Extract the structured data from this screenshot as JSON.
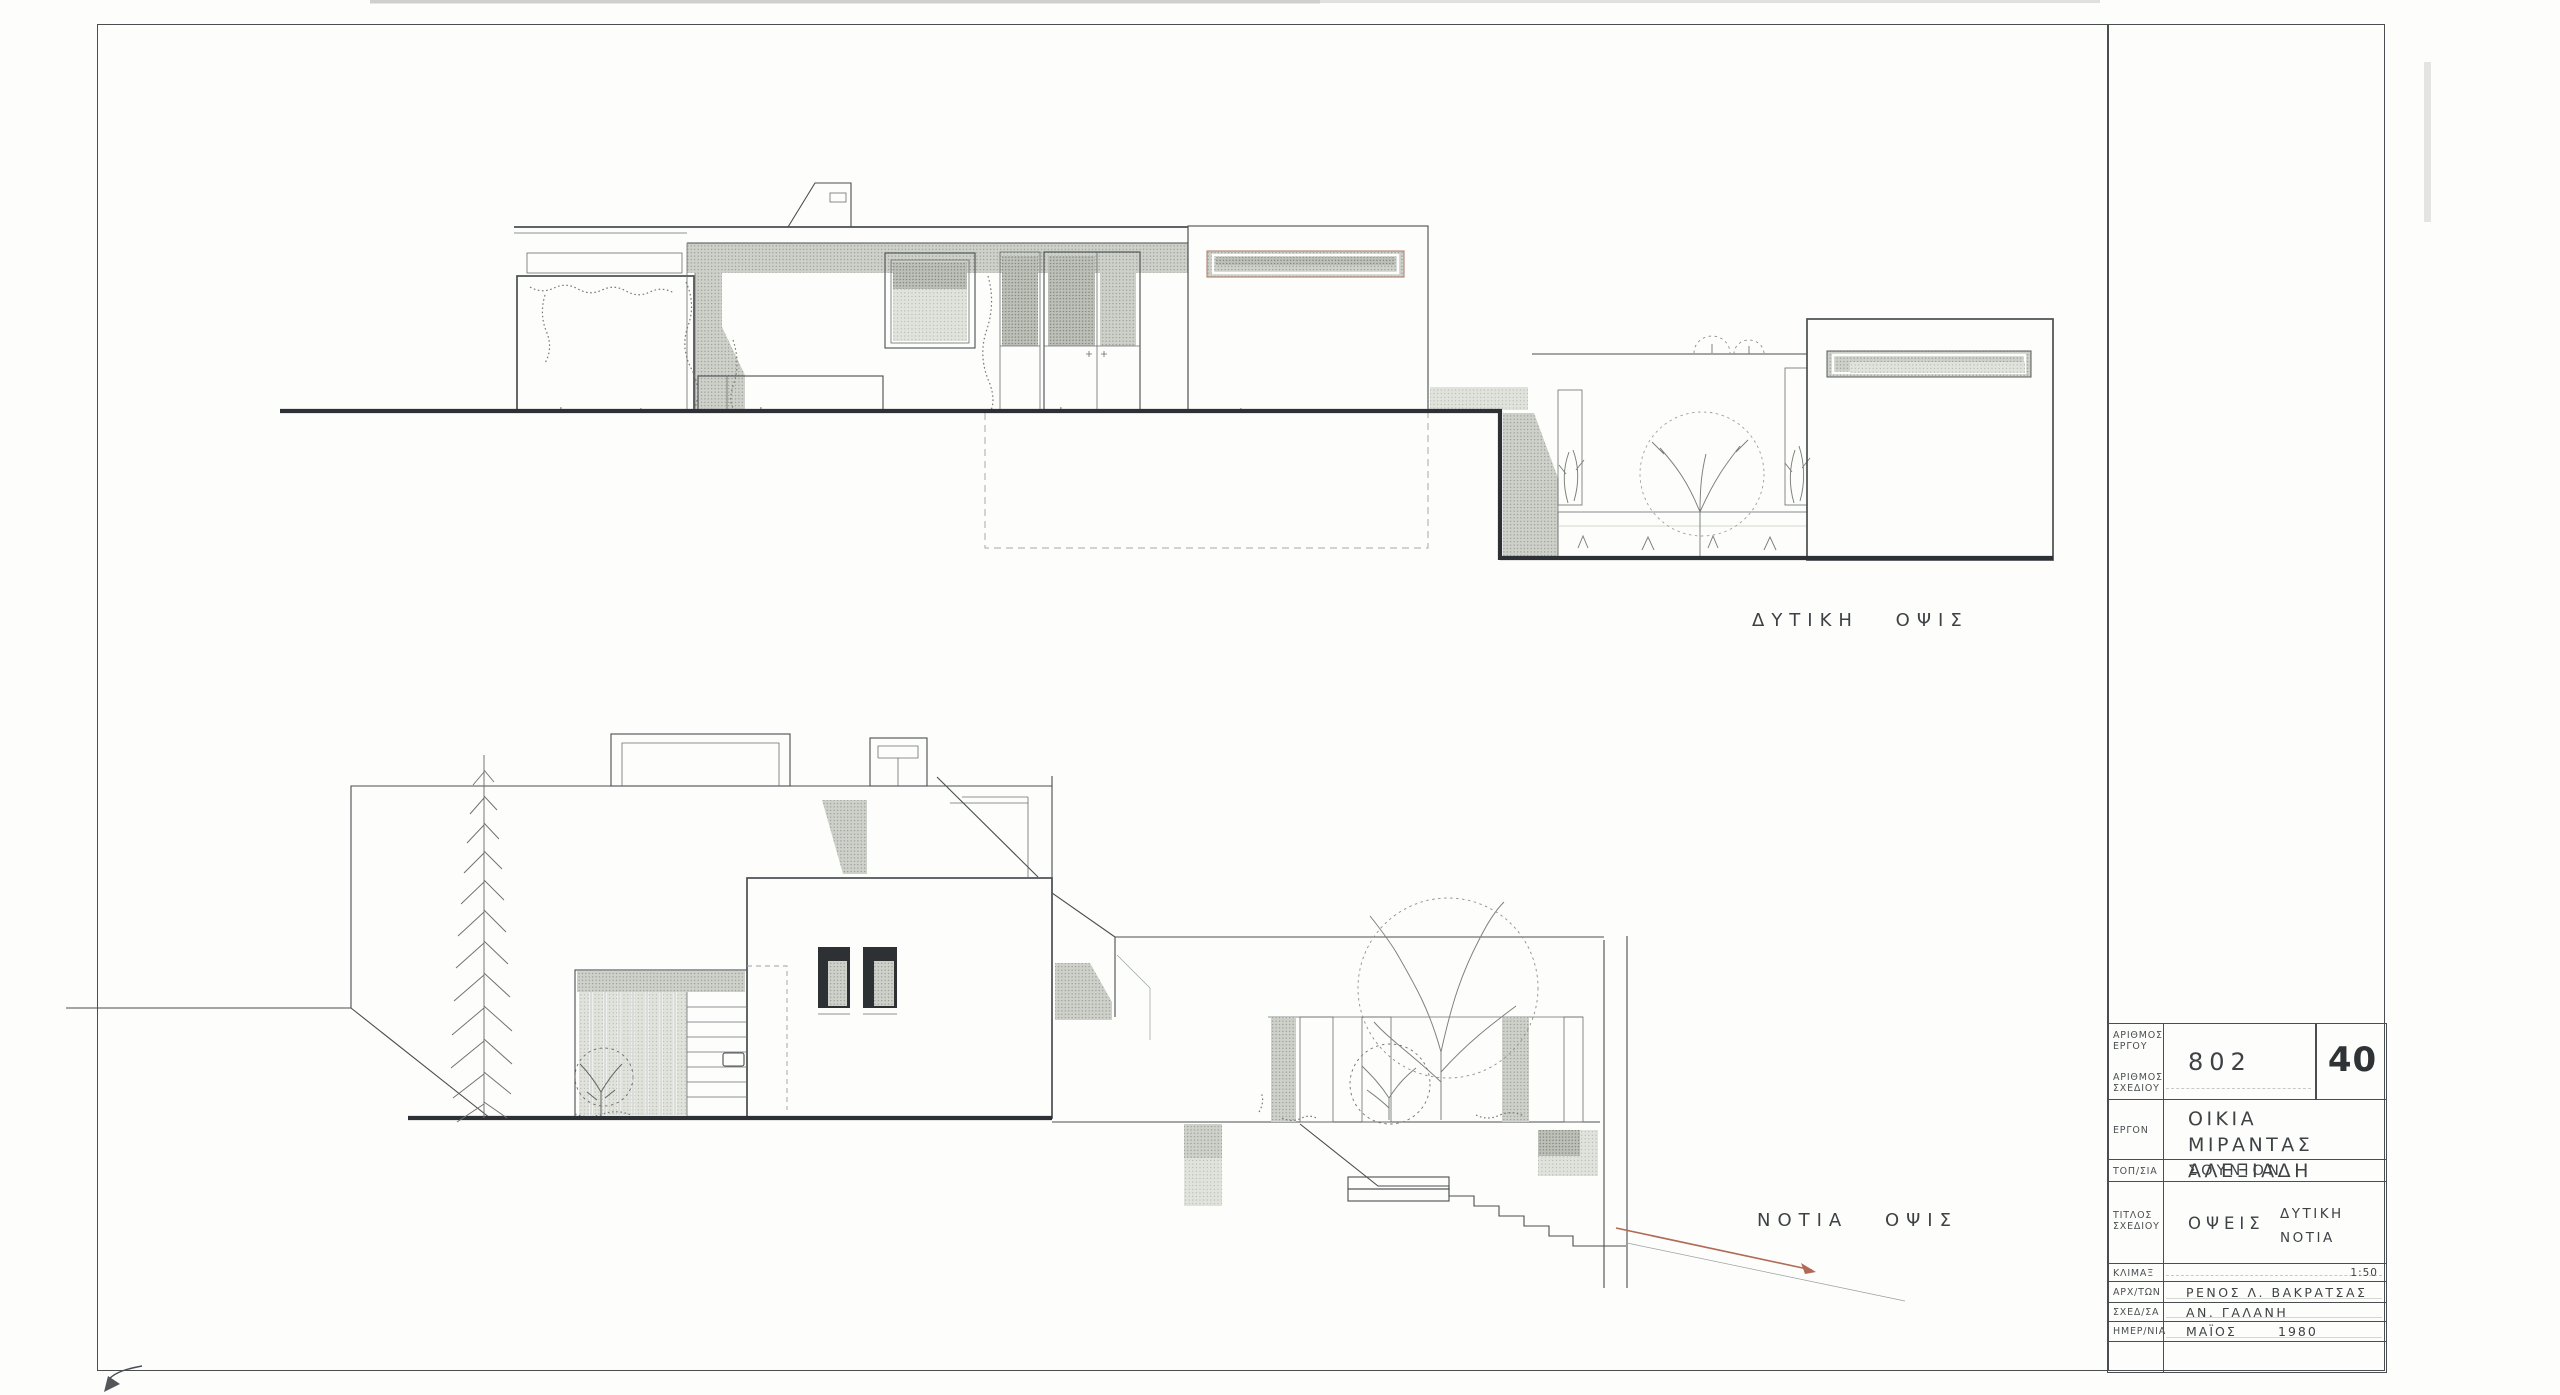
{
  "sheet": {
    "type": "architectural-elevation-drawing",
    "west_label": "ΔΥΤΙΚΗ ΟΨΙΣ",
    "south_label": "ΝΟΤΙΑ ΟΨΙΣ"
  },
  "titleblock": {
    "project_number_label": "ΑΡΙΘΜΟΣ\nΕΡΓΟΥ",
    "drawing_number_label": "ΑΡΙΘΜΟΣ\nΣΧΕΔΙΟΥ",
    "project_number": "802",
    "drawing_number": "40",
    "project_label": "ΕΡΓΟΝ",
    "project_name_line1": "ΟΙΚΙΑ",
    "project_name_line2": "ΜΙΡΑΝΤΑΣ ΑΛΕΞΙΑΔΗ",
    "location_label": "ΤΟΠ/ΣΙΑ",
    "location_value": "ΣΟΥΝΙΟΝ",
    "drawing_title_label": "ΤΙΤΛΟΣ\nΣΧΕΔΙΟΥ",
    "drawing_title_value": "ΟΨΕΙΣ",
    "drawing_title_sub1": "ΔΥΤΙΚΗ",
    "drawing_title_sub2": "ΝΟΤΙΑ",
    "scale_label": "ΚΛΙΜΑΞ",
    "scale_value": "1:50",
    "architect_label": "ΑΡΧ/ΤΩΝ",
    "architect_value": "ΡΕΝΟΣ Λ. ΒΑΚΡΑΤΣΑΣ",
    "draftsman_label": "ΣΧΕΔ/ΣΑ",
    "draftsman_value": "ΑΝ. ΓΑΛΑΝΗ",
    "date_label": "ΗΜΕΡ/ΝΙΑ",
    "date_month": "ΜΑΪΟΣ",
    "date_year": "1980"
  },
  "colors": {
    "paper": "#fdfdfc",
    "line": "#4a4e50",
    "heavy_line": "#2d3135",
    "faint_line": "#6a6e70",
    "stipple_dot": "#8d928a",
    "red_accent": "#b06a55",
    "slot_window_frame_red": "#bb8a79",
    "dark_window": "#2d3134",
    "text": "#3e4245"
  }
}
